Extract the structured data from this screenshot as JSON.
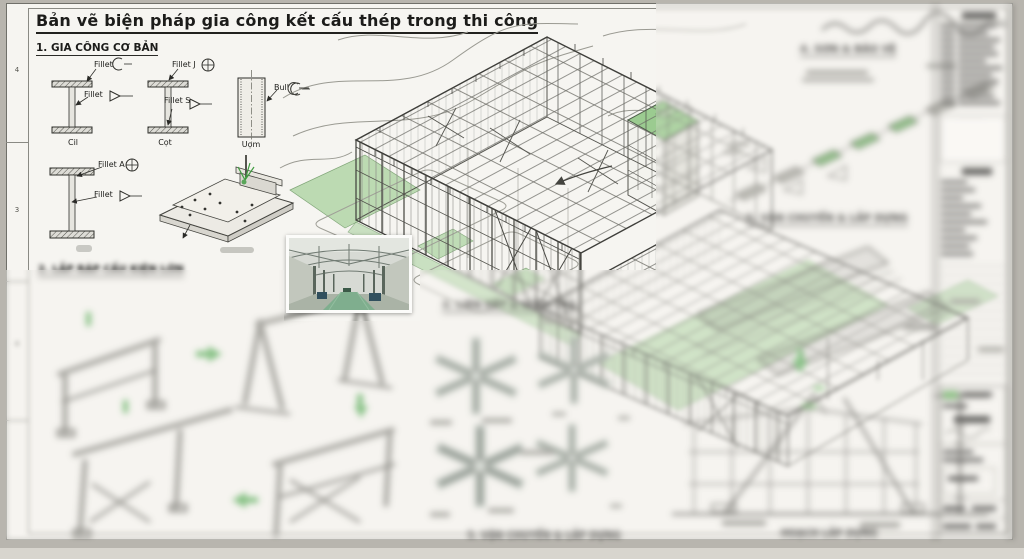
{
  "sheet": {
    "title": "Bản vẽ biện pháp gia công kết cấu thép trong thi công",
    "margin_marks": [
      "4",
      "3",
      "4"
    ]
  },
  "section1": {
    "heading": "1. GIA CÔNG CƠ BẢN",
    "details": {
      "beam1": {
        "label_top": "Fillet",
        "label_mid": "Fillet",
        "caption": "Cil"
      },
      "beam2": {
        "label_top": "Fillet J",
        "label_mid": "Fillet S",
        "caption": "Cọt"
      },
      "plate": {
        "label": "Bull",
        "caption": "Uọm"
      },
      "beam3": {
        "label_top": "Fillet A",
        "label_mid": "Fillet"
      }
    }
  },
  "section2": {
    "heading": "2. LẮP RÁP CẤU KIỆN LỚN"
  },
  "section3": {
    "heading": "3. LIÊN KẾT & KIỂM TRA",
    "caption": "5. VẬN CHUYỂN & LẮP DỰNG"
  },
  "section4": {
    "heading": "4. SƠN & BẢO VỆ"
  },
  "section5": {
    "heading": "5. VẬN CHUYỂN & LẮP DỰNG"
  },
  "elevation": {
    "caption": "HOẠCH LẮP DỰNG"
  },
  "colors": {
    "accent_green": "#7cbf74",
    "ground_green": "#b2d6a8",
    "paper": "#f6f5f1"
  }
}
